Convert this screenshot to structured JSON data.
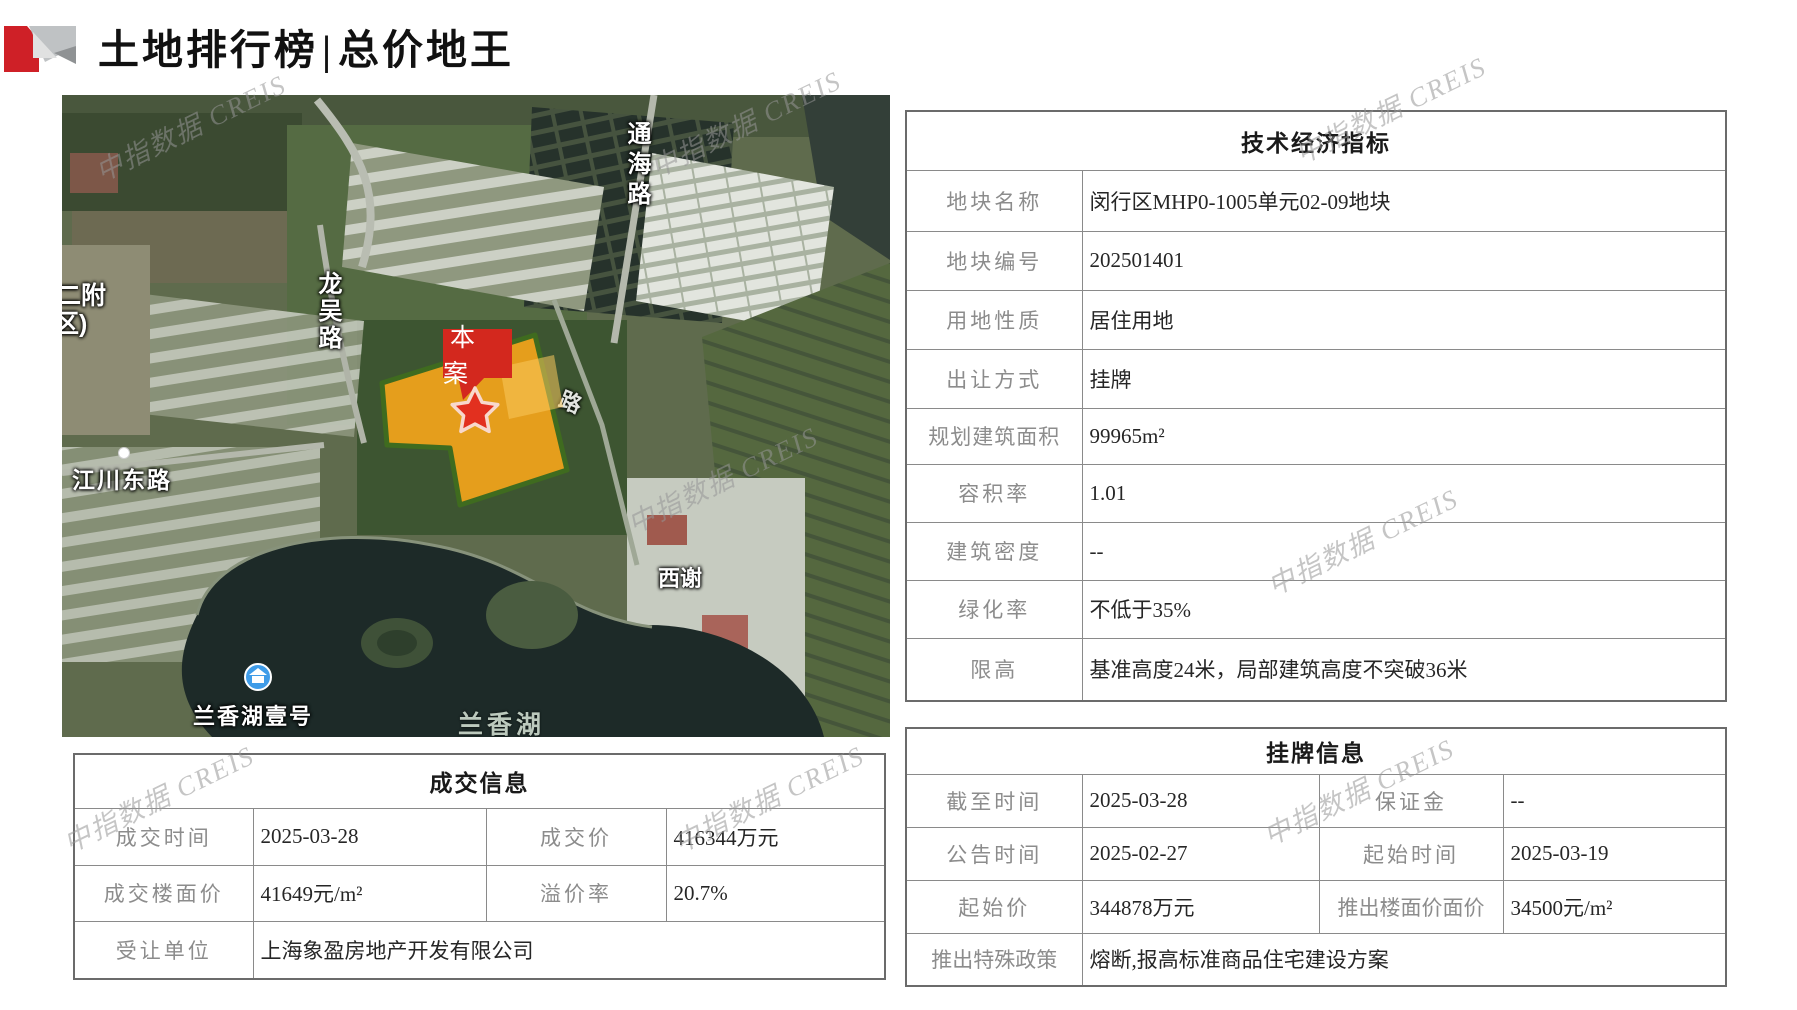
{
  "page": {
    "title_part1": "土地排行榜",
    "title_divider": "|",
    "title_part2": "总价地王"
  },
  "watermark": {
    "text": "中指数据 CREIS"
  },
  "map": {
    "labels": {
      "road_tonghai": "通海路",
      "road_longwu": "龙吴路",
      "road_jiangchuan": "江川东路",
      "edge_partial_line1": "二附",
      "edge_partial_line2": "区)",
      "village_xixie": "西谢",
      "poi_lanxianghu_yihao": "兰香湖壹号",
      "lake_lanxianghu": "兰香湖",
      "road_partial": "路",
      "site_marker": "本案"
    },
    "colors": {
      "plot_fill": "#F7A61B",
      "plot_border": "#3F6B1F",
      "marker_red": "#D3281E",
      "star_red": "#E2301F",
      "poi_blue": "#3F9CE8"
    }
  },
  "tech_table": {
    "title": "技术经济指标",
    "rows": [
      {
        "label": "地块名称",
        "value": "闵行区MHP0-1005单元02-09地块"
      },
      {
        "label": "地块编号",
        "value": "202501401"
      },
      {
        "label": "用地性质",
        "value": "居住用地"
      },
      {
        "label": "出让方式",
        "value": "挂牌"
      },
      {
        "label": "规划建筑面积",
        "value": "99965m²"
      },
      {
        "label": "容积率",
        "value": "1.01"
      },
      {
        "label": "建筑密度",
        "value": "--"
      },
      {
        "label": "绿化率",
        "value": "不低于35%"
      },
      {
        "label": "限高",
        "value": "基准高度24米，局部建筑高度不突破36米"
      }
    ]
  },
  "deal_table": {
    "title": "成交信息",
    "rows": [
      {
        "label1": "成交时间",
        "value1": "2025-03-28",
        "label2": "成交价",
        "value2": "416344万元"
      },
      {
        "label1": "成交楼面价",
        "value1": "41649元/m²",
        "label2": "溢价率",
        "value2": "20.7%"
      },
      {
        "label1": "受让单位",
        "value1": "上海象盈房地产开发有限公司"
      }
    ]
  },
  "listing_table": {
    "title": "挂牌信息",
    "rows": [
      {
        "label1": "截至时间",
        "value1": "2025-03-28",
        "label2": "保证金",
        "value2": "--"
      },
      {
        "label1": "公告时间",
        "value1": "2025-02-27",
        "label2": "起始时间",
        "value2": "2025-03-19"
      },
      {
        "label1": "起始价",
        "value1": "344878万元",
        "label2": "推出楼面价面价",
        "value2": "34500元/m²"
      },
      {
        "label1": "推出特殊政策",
        "value1": "熔断,报高标准商品住宅建设方案"
      }
    ]
  }
}
